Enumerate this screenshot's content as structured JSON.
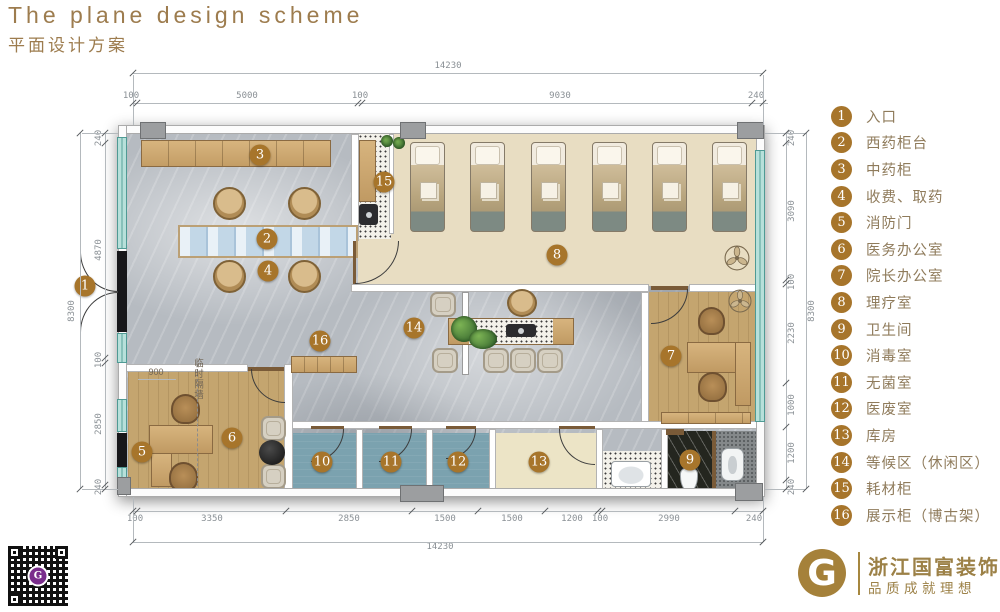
{
  "header": {
    "title_en": "The plane design scheme",
    "title_zh": "平面设计方案"
  },
  "colors": {
    "accent_gold": "#a7752b",
    "title_gold": "#9d7c4e",
    "window_teal": "#b7e0da",
    "floor_marble": "#b6bbc1",
    "floor_cream": "#e8ddc2",
    "floor_blue": "#7ba2af",
    "floor_wood": "#c4a56f",
    "qr_center_purple": "#7a2d8c"
  },
  "legend": {
    "items": [
      {
        "num": "1",
        "label": "入口"
      },
      {
        "num": "2",
        "label": "西药柜台"
      },
      {
        "num": "3",
        "label": "中药柜"
      },
      {
        "num": "4",
        "label": "收费、取药"
      },
      {
        "num": "5",
        "label": "消防门"
      },
      {
        "num": "6",
        "label": "医务办公室"
      },
      {
        "num": "7",
        "label": "院长办公室"
      },
      {
        "num": "8",
        "label": "理疗室"
      },
      {
        "num": "9",
        "label": "卫生间"
      },
      {
        "num": "10",
        "label": "消毒室"
      },
      {
        "num": "11",
        "label": "无菌室"
      },
      {
        "num": "12",
        "label": "医废室"
      },
      {
        "num": "13",
        "label": "库房"
      },
      {
        "num": "14",
        "label": "等候区（休闲区）"
      },
      {
        "num": "15",
        "label": "耗材柜"
      },
      {
        "num": "16",
        "label": "展示柜（博古架）"
      }
    ]
  },
  "plan": {
    "badges": [
      {
        "n": "1",
        "x": 85,
        "y": 286
      },
      {
        "n": "2",
        "x": 267,
        "y": 239
      },
      {
        "n": "3",
        "x": 260,
        "y": 155
      },
      {
        "n": "4",
        "x": 268,
        "y": 271
      },
      {
        "n": "5",
        "x": 142,
        "y": 452
      },
      {
        "n": "6",
        "x": 232,
        "y": 438
      },
      {
        "n": "7",
        "x": 671,
        "y": 356
      },
      {
        "n": "8",
        "x": 557,
        "y": 255
      },
      {
        "n": "9",
        "x": 690,
        "y": 460
      },
      {
        "n": "10",
        "x": 322,
        "y": 462
      },
      {
        "n": "11",
        "x": 391,
        "y": 462
      },
      {
        "n": "12",
        "x": 458,
        "y": 462
      },
      {
        "n": "13",
        "x": 539,
        "y": 462
      },
      {
        "n": "14",
        "x": 414,
        "y": 328
      },
      {
        "n": "15",
        "x": 384,
        "y": 182
      },
      {
        "n": "16",
        "x": 320,
        "y": 341
      }
    ],
    "labels": [
      {
        "t": "900",
        "x": 156,
        "y": 372,
        "vertical": false
      },
      {
        "t": "临时隔墙",
        "x": 197,
        "y": 358,
        "vertical": true
      }
    ]
  },
  "dims": {
    "top": {
      "total": {
        "t": "14230",
        "x": 448,
        "y": 66
      },
      "segments": [
        {
          "t": "100",
          "x": 131,
          "y": 96
        },
        {
          "t": "5000",
          "x": 247,
          "y": 96
        },
        {
          "t": "100",
          "x": 360,
          "y": 96
        },
        {
          "t": "9030",
          "x": 560,
          "y": 96
        },
        {
          "t": "240",
          "x": 756,
          "y": 96
        }
      ]
    },
    "bottom": {
      "total": {
        "t": "14230",
        "x": 440,
        "y": 547
      },
      "segments": [
        {
          "t": "100",
          "x": 135,
          "y": 519
        },
        {
          "t": "3350",
          "x": 212,
          "y": 519
        },
        {
          "t": "2850",
          "x": 349,
          "y": 519
        },
        {
          "t": "1500",
          "x": 445,
          "y": 519
        },
        {
          "t": "1500",
          "x": 512,
          "y": 519
        },
        {
          "t": "1200",
          "x": 572,
          "y": 519
        },
        {
          "t": "100",
          "x": 600,
          "y": 519
        },
        {
          "t": "2990",
          "x": 669,
          "y": 519
        },
        {
          "t": "240",
          "x": 754,
          "y": 519
        }
      ]
    },
    "left": {
      "total": {
        "t": "8300",
        "x": 72,
        "y": 311
      },
      "segments": [
        {
          "t": "240",
          "x": 99,
          "y": 138
        },
        {
          "t": "4870",
          "x": 99,
          "y": 250
        },
        {
          "t": "100",
          "x": 99,
          "y": 360
        },
        {
          "t": "2850",
          "x": 99,
          "y": 424
        },
        {
          "t": "240",
          "x": 99,
          "y": 487
        }
      ]
    },
    "right": {
      "total": {
        "t": "8300",
        "x": 812,
        "y": 311
      },
      "segments": [
        {
          "t": "240",
          "x": 792,
          "y": 138
        },
        {
          "t": "3090",
          "x": 792,
          "y": 211
        },
        {
          "t": "100",
          "x": 792,
          "y": 282
        },
        {
          "t": "2230",
          "x": 792,
          "y": 333
        },
        {
          "t": "1000",
          "x": 792,
          "y": 405
        },
        {
          "t": "1200",
          "x": 792,
          "y": 453
        },
        {
          "t": "240",
          "x": 792,
          "y": 487
        }
      ]
    }
  },
  "footer": {
    "brand": "浙江国富装饰",
    "slogan": "品质成就理想",
    "logo_letter": "G",
    "qr_letter": "G"
  }
}
